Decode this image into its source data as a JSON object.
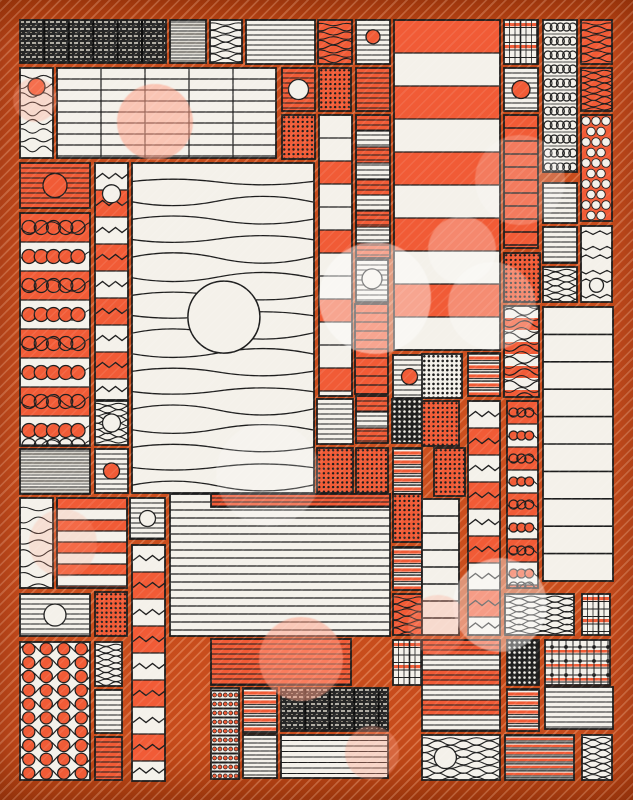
{
  "artwork": {
    "kind": "abstract-generative-quilt",
    "canvas": {
      "width": 633,
      "height": 800,
      "margin": 20
    }
  },
  "palette": {
    "background_orange": "#c54b1c",
    "tile_orange": "#f15b36",
    "tile_white": "#f4f1ea",
    "tile_black": "#1f1f1f",
    "ink": "#1d1d1d",
    "gray": "#777777",
    "bokeh_pink": "255,160,135",
    "bokeh_white": "255,255,255"
  },
  "pattern_legend": {
    "hl": "horizontal-stripes",
    "gridtable": "table-grid",
    "waves": "wavy-lines",
    "zzrows": "zigzag-rows",
    "zzblocks": "zigzag-blocks-column",
    "chainbands": "chain-circle-bands",
    "chainrings": "ring-chain-rows",
    "beads": "bead-stripe-rows",
    "bigdots": "big-dot-grid",
    "polka": "polka-dots",
    "dots": "dot-grid",
    "plaid": "plaid-grid",
    "plaiddots": "grid-with-dots",
    "weave": "dark-tweed-weave",
    "gray": "gray-layered-stripes",
    "mixed": "black-orange-stripes",
    "bands": "solid-bands",
    "wavesbands": "waves-over-bands"
  },
  "tiles": [
    {
      "x": 20,
      "y": 20,
      "w": 146,
      "h": 43,
      "pat": "weave"
    },
    {
      "x": 170,
      "y": 20,
      "w": 36,
      "h": 43,
      "bg": "w",
      "pat": "gray"
    },
    {
      "x": 210,
      "y": 20,
      "w": 32,
      "h": 43,
      "bg": "w",
      "pat": "waves",
      "p": {
        "g": 4,
        "amp": 1.6,
        "wl": 26
      }
    },
    {
      "x": 246,
      "y": 20,
      "w": 69,
      "h": 44,
      "bg": "w",
      "pat": "hl",
      "p": {
        "g": 5
      }
    },
    {
      "x": 318,
      "y": 20,
      "w": 34,
      "h": 44,
      "bg": "o",
      "pat": "waves",
      "p": {
        "g": 4.5,
        "amp": 1.6,
        "wl": 26
      }
    },
    {
      "x": 356,
      "y": 20,
      "w": 34,
      "h": 44,
      "bg": "w",
      "pat": "hl",
      "p": {
        "g": 5
      },
      "circle": {
        "x": 0.5,
        "y": 0.38,
        "r": 7,
        "f": "o"
      }
    },
    {
      "x": 394,
      "y": 20,
      "w": 106,
      "h": 330,
      "pat": "bands",
      "p": {
        "h": 33,
        "seq": [
          "o",
          "w"
        ]
      }
    },
    {
      "x": 504,
      "y": 20,
      "w": 34,
      "h": 44,
      "bg": "w",
      "pat": "plaid"
    },
    {
      "x": 543,
      "y": 20,
      "w": 34,
      "h": 152,
      "bg": "w",
      "pat": "chainrings",
      "p": {
        "rh": 14
      }
    },
    {
      "x": 581,
      "y": 20,
      "w": 31,
      "h": 44,
      "bg": "o",
      "pat": "waves",
      "p": {
        "g": 4,
        "amp": 1.6,
        "wl": 26
      }
    },
    {
      "x": 581,
      "y": 68,
      "w": 31,
      "h": 43,
      "bg": "o",
      "pat": "waves",
      "p": {
        "g": 3.4,
        "amp": 1.5,
        "wl": 22
      }
    },
    {
      "x": 581,
      "y": 115,
      "w": 31,
      "h": 106,
      "bg": "o",
      "pat": "polka"
    },
    {
      "x": 581,
      "y": 226,
      "w": 31,
      "h": 76,
      "bg": "w",
      "pat": "zzrows",
      "p": {
        "g": 12,
        "amp": 3.5,
        "wl": 14
      },
      "circle": {
        "x": 0.5,
        "y": 0.78,
        "r": 7,
        "f": "w"
      }
    },
    {
      "x": 543,
      "y": 183,
      "w": 34,
      "h": 40,
      "bg": "w",
      "pat": "hl",
      "p": {
        "g": 5
      }
    },
    {
      "x": 543,
      "y": 227,
      "w": 34,
      "h": 36,
      "bg": "w",
      "pat": "hl",
      "p": {
        "g": 5
      }
    },
    {
      "x": 543,
      "y": 267,
      "w": 34,
      "h": 35,
      "bg": "w",
      "pat": "waves",
      "p": {
        "g": 3.4,
        "amp": 1.6,
        "wl": 22
      }
    },
    {
      "x": 504,
      "y": 68,
      "w": 34,
      "h": 43,
      "bg": "w",
      "pat": "hl",
      "p": {
        "g": 5
      },
      "circle": {
        "x": 0.5,
        "y": 0.5,
        "r": 9,
        "f": "o"
      }
    },
    {
      "x": 504,
      "y": 115,
      "w": 34,
      "h": 133,
      "bg": "o",
      "pat": "hl",
      "p": {
        "g": 13,
        "lw": 1.4
      }
    },
    {
      "x": 504,
      "y": 253,
      "w": 36,
      "h": 49,
      "bg": "o",
      "pat": "dots",
      "p": {
        "g": 4.6,
        "r": 1.2
      }
    },
    {
      "x": 504,
      "y": 306,
      "w": 35,
      "h": 91,
      "pat": "wavesbands",
      "p": {
        "h": 12
      }
    },
    {
      "x": 507,
      "y": 401,
      "w": 31,
      "h": 187,
      "pat": "chainbands",
      "p": {
        "rh": 23,
        "r": 4.5
      }
    },
    {
      "x": 543,
      "y": 307,
      "w": 70,
      "h": 274,
      "bg": "w",
      "pat": "hl",
      "p": {
        "g": 27.4,
        "lw": 1.6
      }
    },
    {
      "x": 20,
      "y": 68,
      "w": 33,
      "h": 90,
      "bg": "w",
      "pat": "waves",
      "p": {
        "g": 9,
        "amp": 2.2,
        "wl": 22
      },
      "circle": {
        "x": 0.5,
        "y": 0.21,
        "r": 8.5,
        "f": "o"
      }
    },
    {
      "x": 57,
      "y": 68,
      "w": 219,
      "h": 90,
      "bg": "w",
      "pat": "gridtable",
      "p": {
        "gy": 11,
        "gx": 44
      }
    },
    {
      "x": 282,
      "y": 68,
      "w": 33,
      "h": 43,
      "bg": "o",
      "pat": "hl",
      "p": {
        "g": 5
      },
      "circle": {
        "x": 0.5,
        "y": 0.5,
        "r": 10,
        "f": "w"
      }
    },
    {
      "x": 319,
      "y": 68,
      "w": 32,
      "h": 43,
      "bg": "o",
      "pat": "dots",
      "p": {
        "g": 4.6,
        "r": 1.2
      }
    },
    {
      "x": 356,
      "y": 68,
      "w": 34,
      "h": 43,
      "bg": "o",
      "pat": "hl",
      "p": {
        "g": 5
      }
    },
    {
      "x": 282,
      "y": 115,
      "w": 33,
      "h": 44,
      "bg": "o",
      "pat": "dots",
      "p": {
        "g": 4.6,
        "r": 1.2
      }
    },
    {
      "x": 319,
      "y": 115,
      "w": 33,
      "h": 281,
      "pat": "bands",
      "p": {
        "h": 23,
        "seq": [
          "w",
          "w",
          "o"
        ]
      }
    },
    {
      "x": 356,
      "y": 115,
      "w": 34,
      "h": 143,
      "pat": "bands",
      "p": {
        "h": 16,
        "seq": [
          "o",
          "w"
        ],
        "lines": 5
      }
    },
    {
      "x": 356,
      "y": 260,
      "w": 32,
      "h": 42,
      "bg": "w",
      "pat": "hl",
      "p": {
        "g": 5
      },
      "circle": {
        "x": 0.5,
        "y": 0.45,
        "r": 10,
        "f": "w"
      }
    },
    {
      "x": 355,
      "y": 304,
      "w": 33,
      "h": 90,
      "bg": "o",
      "pat": "hl",
      "p": {
        "g": 9,
        "lw": 1.3
      }
    },
    {
      "x": 356,
      "y": 396,
      "w": 32,
      "h": 47,
      "pat": "bands",
      "p": {
        "h": 16,
        "seq": [
          "o",
          "w"
        ],
        "lines": 5
      }
    },
    {
      "x": 356,
      "y": 448,
      "w": 32,
      "h": 45,
      "bg": "o",
      "pat": "dots",
      "p": {
        "g": 4.6,
        "r": 1.2
      }
    },
    {
      "x": 317,
      "y": 399,
      "w": 36,
      "h": 45,
      "bg": "w",
      "pat": "hl",
      "p": {
        "g": 5
      }
    },
    {
      "x": 317,
      "y": 448,
      "w": 36,
      "h": 45,
      "bg": "o",
      "pat": "dots",
      "p": {
        "g": 4.6,
        "r": 1.2
      }
    },
    {
      "x": 393,
      "y": 355,
      "w": 33,
      "h": 43,
      "bg": "w",
      "pat": "hl",
      "p": {
        "g": 5
      },
      "circle": {
        "x": 0.5,
        "y": 0.5,
        "r": 8,
        "f": "o"
      }
    },
    {
      "x": 392,
      "y": 399,
      "w": 30,
      "h": 44,
      "bg": "k",
      "pat": "dots",
      "p": {
        "g": 5,
        "r": 1.3,
        "c": "w"
      }
    },
    {
      "x": 393,
      "y": 448,
      "w": 29,
      "h": 46,
      "bg": "w",
      "pat": "mixed"
    },
    {
      "x": 20,
      "y": 163,
      "w": 70,
      "h": 45,
      "bg": "o",
      "pat": "hl",
      "p": {
        "g": 5
      },
      "circle": {
        "x": 0.5,
        "y": 0.5,
        "r": 12,
        "f": "o"
      }
    },
    {
      "x": 95,
      "y": 163,
      "w": 33,
      "h": 237,
      "pat": "zzblocks",
      "p": {
        "rh": 27
      },
      "circle": {
        "x": 0.5,
        "y": 0.13,
        "r": 9,
        "f": "w"
      }
    },
    {
      "x": 20,
      "y": 213,
      "w": 70,
      "h": 233,
      "pat": "chainbands",
      "p": {
        "rh": 29,
        "r": 7
      }
    },
    {
      "x": 132,
      "y": 163,
      "w": 182,
      "h": 330,
      "bg": "w",
      "pat": "waves",
      "p": {
        "g": 19,
        "amp": 4,
        "wl": 180,
        "lw": 1.3
      },
      "circle": {
        "x": 0.505,
        "y": 0.467,
        "r": 36,
        "f": "w",
        "sw": 1.5
      }
    },
    {
      "x": 20,
      "y": 449,
      "w": 70,
      "h": 45,
      "bg": "w",
      "pat": "gray"
    },
    {
      "x": 95,
      "y": 401,
      "w": 33,
      "h": 44,
      "bg": "w",
      "pat": "waves",
      "p": {
        "g": 3.4,
        "amp": 1.6,
        "wl": 22
      },
      "circle": {
        "x": 0.5,
        "y": 0.5,
        "r": 9,
        "f": "w"
      }
    },
    {
      "x": 95,
      "y": 449,
      "w": 33,
      "h": 44,
      "bg": "w",
      "pat": "hl",
      "p": {
        "g": 5
      },
      "circle": {
        "x": 0.5,
        "y": 0.5,
        "r": 8,
        "f": "o"
      }
    },
    {
      "x": 20,
      "y": 498,
      "w": 33,
      "h": 90,
      "bg": "w",
      "pat": "waves",
      "p": {
        "g": 11,
        "amp": 2.5,
        "wl": 30
      }
    },
    {
      "x": 57,
      "y": 498,
      "w": 70,
      "h": 90,
      "pat": "bands",
      "p": {
        "h": 11,
        "seq": [
          "o",
          "w"
        ]
      }
    },
    {
      "x": 130,
      "y": 498,
      "w": 35,
      "h": 41,
      "bg": "w",
      "pat": "hl",
      "p": {
        "g": 5
      },
      "circle": {
        "x": 0.5,
        "y": 0.5,
        "r": 8,
        "f": "w"
      }
    },
    {
      "x": 132,
      "y": 545,
      "w": 33,
      "h": 236,
      "pat": "zzblocks",
      "p": {
        "rh": 27
      }
    },
    {
      "x": 20,
      "y": 594,
      "w": 70,
      "h": 42,
      "bg": "w",
      "pat": "hl",
      "p": {
        "g": 5
      },
      "circle": {
        "x": 0.5,
        "y": 0.5,
        "r": 11,
        "f": "w"
      }
    },
    {
      "x": 95,
      "y": 592,
      "w": 32,
      "h": 44,
      "bg": "o",
      "pat": "dots",
      "p": {
        "g": 4.6,
        "r": 1.2
      }
    },
    {
      "x": 20,
      "y": 642,
      "w": 70,
      "h": 138,
      "bg": "w",
      "pat": "bigdots",
      "p": {
        "cols": 4,
        "rh": 13.8
      }
    },
    {
      "x": 95,
      "y": 642,
      "w": 27,
      "h": 44,
      "bg": "w",
      "pat": "waves",
      "p": {
        "g": 3.2,
        "amp": 1.5,
        "wl": 20
      }
    },
    {
      "x": 95,
      "y": 690,
      "w": 27,
      "h": 43,
      "bg": "w",
      "pat": "hl",
      "p": {
        "g": 5
      }
    },
    {
      "x": 95,
      "y": 737,
      "w": 27,
      "h": 43,
      "bg": "o",
      "pat": "hl",
      "p": {
        "g": 5
      }
    },
    {
      "x": 170,
      "y": 494,
      "w": 220,
      "h": 142,
      "bg": "w",
      "pat": "hl",
      "p": {
        "g": 8,
        "lw": 1.2
      }
    },
    {
      "x": 211,
      "y": 494,
      "w": 179,
      "h": 13,
      "bg": "o",
      "pat": "hl",
      "p": {
        "g": 4
      }
    },
    {
      "x": 211,
      "y": 639,
      "w": 140,
      "h": 46,
      "bg": "o",
      "pat": "hl",
      "p": {
        "g": 5
      }
    },
    {
      "x": 211,
      "y": 688,
      "w": 28,
      "h": 91,
      "bg": "w",
      "pat": "beads",
      "p": {
        "rh": 9
      }
    },
    {
      "x": 243,
      "y": 688,
      "w": 34,
      "h": 45,
      "bg": "w",
      "pat": "mixed"
    },
    {
      "x": 243,
      "y": 735,
      "w": 34,
      "h": 43,
      "bg": "w",
      "pat": "hl",
      "p": {
        "g": 4
      }
    },
    {
      "x": 281,
      "y": 688,
      "w": 107,
      "h": 43,
      "pat": "weave"
    },
    {
      "x": 281,
      "y": 735,
      "w": 107,
      "h": 43,
      "bg": "w",
      "pat": "hl",
      "p": {
        "g": 5.5
      }
    },
    {
      "x": 393,
      "y": 494,
      "w": 29,
      "h": 48,
      "bg": "o",
      "pat": "dots",
      "p": {
        "g": 4.6,
        "r": 1.2
      }
    },
    {
      "x": 393,
      "y": 547,
      "w": 29,
      "h": 43,
      "bg": "w",
      "pat": "mixed"
    },
    {
      "x": 393,
      "y": 594,
      "w": 29,
      "h": 41,
      "bg": "o",
      "pat": "waves",
      "p": {
        "g": 4,
        "amp": 1.6,
        "wl": 24
      }
    },
    {
      "x": 393,
      "y": 640,
      "w": 29,
      "h": 45,
      "bg": "w",
      "pat": "plaid"
    },
    {
      "x": 422,
      "y": 354,
      "w": 40,
      "h": 44,
      "bg": "w",
      "pat": "dots",
      "p": {
        "g": 4.6,
        "r": 1.3
      }
    },
    {
      "x": 468,
      "y": 353,
      "w": 32,
      "h": 43,
      "bg": "w",
      "pat": "mixed"
    },
    {
      "x": 422,
      "y": 401,
      "w": 37,
      "h": 45,
      "bg": "o",
      "pat": "dots",
      "p": {
        "g": 4.6,
        "r": 1.2
      }
    },
    {
      "x": 434,
      "y": 448,
      "w": 31,
      "h": 48,
      "bg": "o",
      "pat": "dots",
      "p": {
        "g": 4.6,
        "r": 1.2
      }
    },
    {
      "x": 422,
      "y": 499,
      "w": 37,
      "h": 136,
      "bg": "w",
      "pat": "hl",
      "p": {
        "g": 17,
        "lw": 1.5
      }
    },
    {
      "x": 468,
      "y": 401,
      "w": 32,
      "h": 234,
      "pat": "zzblocks",
      "p": {
        "rh": 27
      }
    },
    {
      "x": 505,
      "y": 594,
      "w": 69,
      "h": 41,
      "bg": "w",
      "pat": "waves",
      "p": {
        "g": 3.2,
        "amp": 1.6,
        "wl": 24
      }
    },
    {
      "x": 582,
      "y": 594,
      "w": 28,
      "h": 41,
      "bg": "w",
      "pat": "plaid"
    },
    {
      "x": 422,
      "y": 640,
      "w": 78,
      "h": 91,
      "pat": "bands",
      "p": {
        "h": 15,
        "seq": [
          "o",
          "w"
        ],
        "lines": 5
      }
    },
    {
      "x": 507,
      "y": 640,
      "w": 32,
      "h": 45,
      "bg": "k",
      "pat": "dots",
      "p": {
        "g": 5,
        "r": 1.3,
        "c": "w"
      }
    },
    {
      "x": 545,
      "y": 640,
      "w": 65,
      "h": 45,
      "bg": "w",
      "pat": "plaiddots"
    },
    {
      "x": 507,
      "y": 689,
      "w": 32,
      "h": 42,
      "bg": "w",
      "pat": "mixed"
    },
    {
      "x": 545,
      "y": 687,
      "w": 68,
      "h": 42,
      "bg": "w",
      "pat": "hl",
      "p": {
        "g": 5
      }
    },
    {
      "x": 422,
      "y": 735,
      "w": 78,
      "h": 45,
      "bg": "w",
      "pat": "waves",
      "p": {
        "g": 4,
        "amp": 1.8,
        "wl": 26
      },
      "circle": {
        "x": 0.3,
        "y": 0.5,
        "r": 11,
        "f": "w"
      }
    },
    {
      "x": 505,
      "y": 735,
      "w": 69,
      "h": 45,
      "bg": "w",
      "pat": "mixed",
      "p": {
        "unit": 7
      }
    },
    {
      "x": 582,
      "y": 735,
      "w": 30,
      "h": 45,
      "bg": "w",
      "pat": "waves",
      "p": {
        "g": 3.4,
        "amp": 1.5,
        "wl": 20
      }
    }
  ],
  "bokeh": [
    {
      "cx": 155,
      "cy": 122,
      "r": 38,
      "c": "pink",
      "o": 0.55
    },
    {
      "cx": 375,
      "cy": 298,
      "r": 56,
      "c": "white",
      "o": 0.45
    },
    {
      "cx": 462,
      "cy": 250,
      "r": 34,
      "c": "white",
      "o": 0.28
    },
    {
      "cx": 492,
      "cy": 306,
      "r": 44,
      "c": "white",
      "o": 0.3
    },
    {
      "cx": 268,
      "cy": 474,
      "r": 52,
      "c": "white",
      "o": 0.2
    },
    {
      "cx": 301,
      "cy": 659,
      "r": 42,
      "c": "pink",
      "o": 0.5
    },
    {
      "cx": 500,
      "cy": 605,
      "r": 47,
      "c": "white",
      "o": 0.4
    },
    {
      "cx": 63,
      "cy": 543,
      "r": 34,
      "c": "pink",
      "o": 0.22
    },
    {
      "cx": 372,
      "cy": 753,
      "r": 27,
      "c": "pink",
      "o": 0.35
    },
    {
      "cx": 438,
      "cy": 625,
      "r": 30,
      "c": "pink",
      "o": 0.28
    },
    {
      "cx": 520,
      "cy": 180,
      "r": 45,
      "c": "white",
      "o": 0.2
    },
    {
      "cx": 35,
      "cy": 100,
      "r": 22,
      "c": "pink",
      "o": 0.3
    }
  ]
}
